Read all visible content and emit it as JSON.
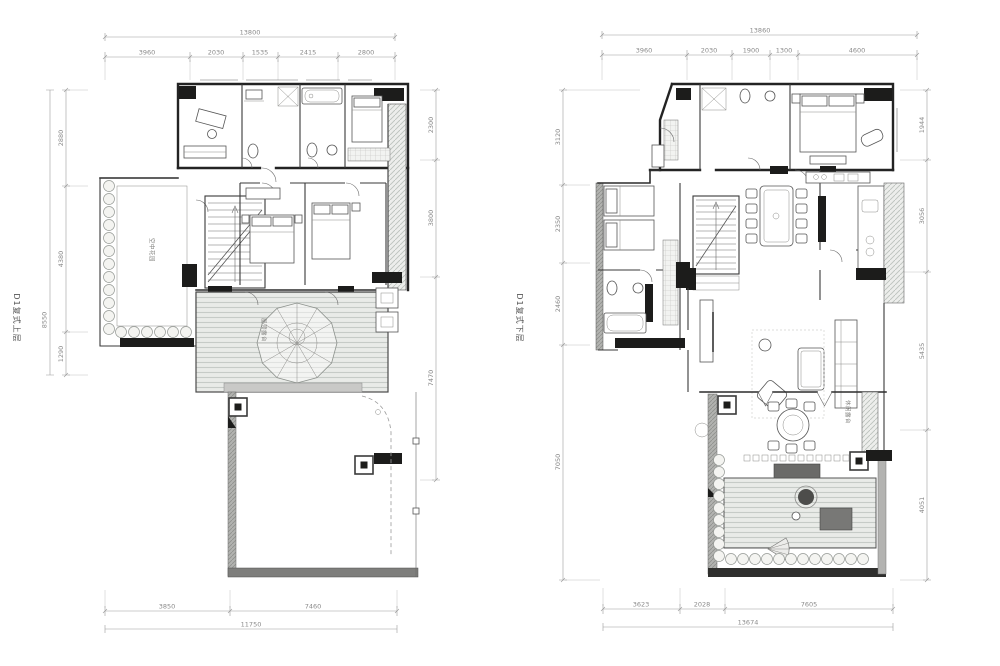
{
  "figure": {
    "background": "#ffffff",
    "wall_ink": "#232323",
    "dim_color": "#8a8a8a",
    "deck_fill": "#e9ebe8",
    "hatch_line": "#bcc2bd"
  },
  "plans": [
    {
      "label": "D1复式上层",
      "dims": {
        "top_total": "13800",
        "top_segments": [
          "3960",
          "2030",
          "1535",
          "2415",
          "2800"
        ],
        "bottom_segments": [
          "3850",
          "7460"
        ],
        "bottom_total": "11750",
        "left_total": "8550",
        "left_segments": [
          "2880",
          "4380",
          "1290"
        ],
        "right_segments": [
          "2300",
          "3800",
          "7470"
        ]
      },
      "room_labels": {
        "garden": "空中花园",
        "terrace": "屋顶露台"
      }
    },
    {
      "label": "D1复式下层",
      "dims": {
        "top_total": "13860",
        "top_segments": [
          "3960",
          "2030",
          "1900",
          "1300",
          "4600"
        ],
        "bottom_segments": [
          "3623",
          "2028",
          "7605"
        ],
        "bottom_total": "13674",
        "left_segments": [
          "3120",
          "2350",
          "2460",
          "7050"
        ],
        "right_segments": [
          "1944",
          "3056",
          "5435",
          "4051"
        ]
      },
      "room_labels": {
        "terrace": "休闲露台"
      }
    }
  ]
}
